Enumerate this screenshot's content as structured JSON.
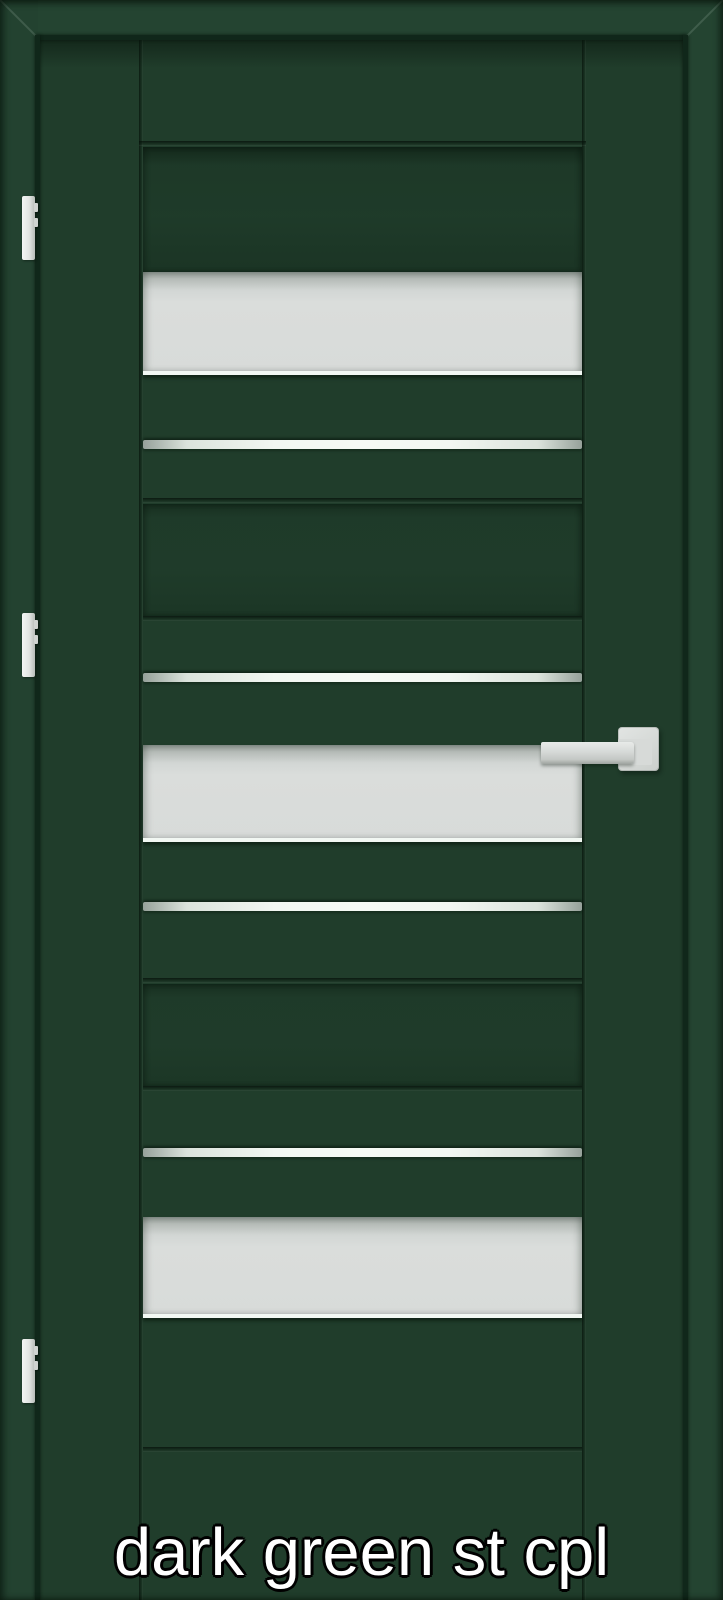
{
  "caption": {
    "text": "dark green st cpl"
  },
  "subject": {
    "type": "interior-door-product-photo",
    "door_finish_label": "dark green st cpl",
    "hinge_count": 3,
    "glass_pane_count": 3,
    "metal_strip_count": 4,
    "door_elements_top_to_bottom": [
      "recessed panel",
      "frosted glass pane",
      "aluminum strip",
      "grooved plank",
      "aluminum strip",
      "frosted glass pane with lever handle",
      "aluminum strip",
      "grooved plank",
      "aluminum strip",
      "frosted glass pane",
      "plain base plank"
    ],
    "colors": {
      "frame_green": "#244431",
      "door_green": "#203d2b",
      "groove_shadow": "#10271a",
      "glass_gray": "#d8dbd9",
      "glass_edge_highlight": "#f2f8f3",
      "metal_strip": "#f6faf5",
      "hardware_gray": "#d6d9d7",
      "hinge_gray": "#e2e5e3",
      "caption_text": "#ffffff",
      "caption_outline": "#000000"
    }
  }
}
